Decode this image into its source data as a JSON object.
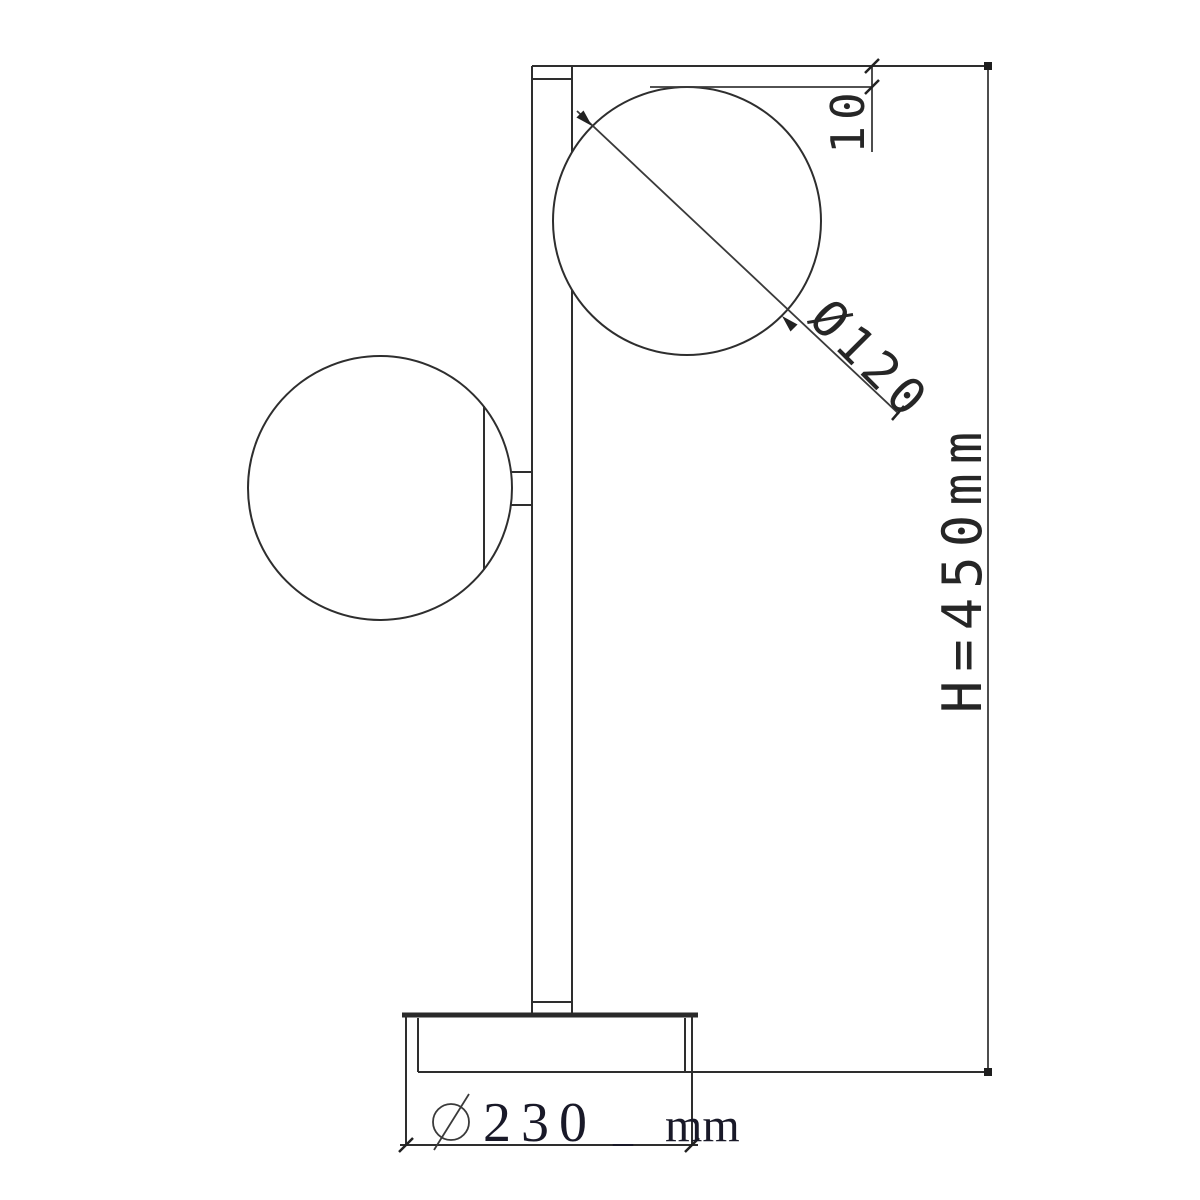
{
  "drawing": {
    "kind": "table-lamp-dimension-drawing",
    "background": "#ffffff",
    "line_color": "#2e2e2e",
    "text_color": "#262626"
  },
  "dims": {
    "top_offset": "10",
    "globe_diameter": "Ø120",
    "height": "H=450mm",
    "base_symbol": "Ø",
    "base_value": "230",
    "base_mark": "_",
    "base_unit": "mm"
  }
}
